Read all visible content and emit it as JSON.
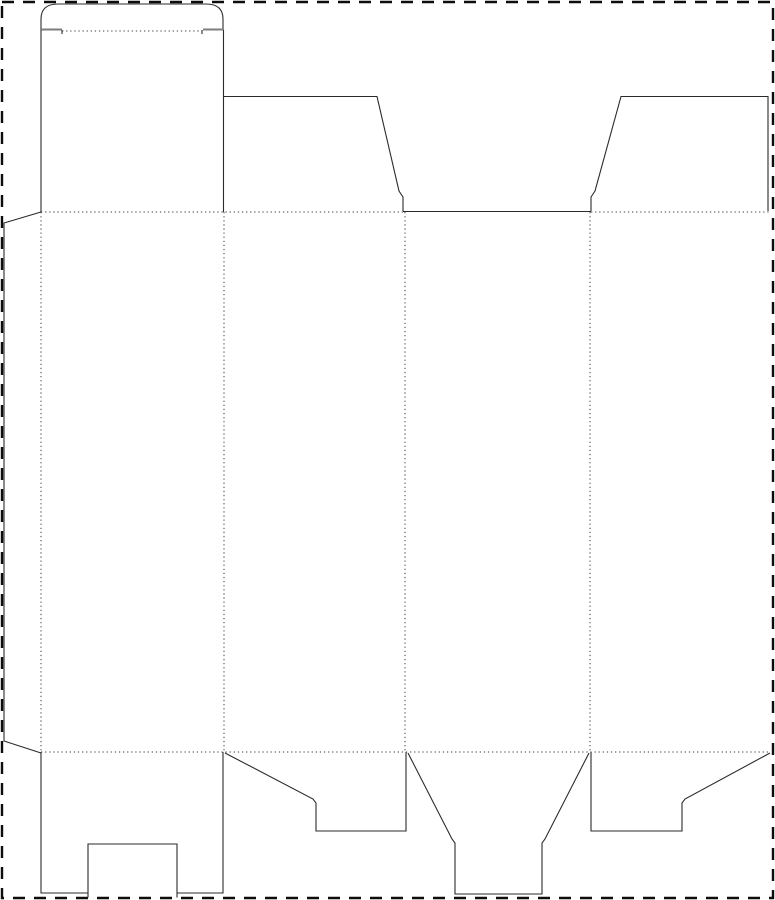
{
  "canvas": {
    "width": 775,
    "height": 900,
    "background": "#ffffff"
  },
  "colors": {
    "cut": "#2b2b2b",
    "fold": "#3f3f3f",
    "border": "#0d0d0d",
    "shoulder": "#7d7d7d"
  },
  "sheet_border": {
    "name": "sheet-border-dashed",
    "x": 2,
    "y": 2,
    "width": 771,
    "height": 896,
    "thickness": 2.4,
    "dash": "12 9"
  },
  "fold_lines": [
    {
      "name": "tuck-crease-fold",
      "d": "M 62 31 H 202"
    },
    {
      "name": "top-fold-left-segment",
      "d": "M 41 212 H 403"
    },
    {
      "name": "top-fold-right-segment",
      "d": "M 591 212 H 770"
    },
    {
      "name": "bottom-fold",
      "d": "M 41 752 H 770"
    },
    {
      "name": "glue-flap-fold",
      "d": "M 41 212 V 752"
    },
    {
      "name": "panel-divider-fold-1",
      "d": "M 224 212 V 752"
    },
    {
      "name": "panel-divider-fold-2",
      "d": "M 405 212 V 752"
    },
    {
      "name": "panel-divider-fold-3",
      "d": "M 590 212 V 752"
    }
  ],
  "cut_lines": [
    {
      "name": "tuck-flap-crown",
      "d": "M 41 30 V 19 Q 41 4 58 4 H 206 Q 223 4 223 19 V 30"
    },
    {
      "name": "tuck-shoulder-left",
      "d": "M 41 29.5 H 62",
      "width": 2,
      "color": "shoulder"
    },
    {
      "name": "tuck-shoulder-right",
      "d": "M 203 29.5 H 223",
      "width": 2,
      "color": "shoulder"
    },
    {
      "name": "tuck-crease-hook-left",
      "d": "M 62 30 V 34"
    },
    {
      "name": "tuck-crease-hook-right",
      "d": "M 202 30 V 34"
    },
    {
      "name": "tuck-neck-left-edge",
      "d": "M 41 30 V 212"
    },
    {
      "name": "tuck-neck-right-edge",
      "d": "M 223.5 30 V 212"
    },
    {
      "name": "top-dust-flap-left",
      "d": "M 224 96.5 H 377 L 399 191 L 403 197 V 211"
    },
    {
      "name": "top-opening-cut",
      "d": "M 403 211.5 H 591"
    },
    {
      "name": "top-dust-flap-right",
      "d": "M 591 211 V 197 L 595 191 L 621 96.5 H 768 V 211"
    },
    {
      "name": "glue-flap-outline",
      "d": "M 41 212 L 4 223 V 741 L 41 753"
    },
    {
      "name": "bottom-flap1-left-side",
      "d": "M 41 752 V 893 H 88"
    },
    {
      "name": "bottom-flap1-right-side",
      "d": "M 177 893 H 223 V 752"
    },
    {
      "name": "bottom-flap1-lock-notch",
      "d": "M 88 897.5 V 844 H 177 V 897.5"
    },
    {
      "name": "bottom-flap2-outline",
      "d": "M 225 753 L 313 799 L 316 803 V 831 H 406 V 752"
    },
    {
      "name": "bottom-flap3-funnel",
      "d": "M 408 753 L 452 839 L 455 843 V 894 H 542 V 843 L 545 839 L 589 753"
    },
    {
      "name": "bottom-flap4-outline",
      "d": "M 591 752 V 831 H 682 V 803 L 685 799 L 770 753"
    }
  ],
  "line_styles": {
    "cut_width": 1.1,
    "fold_width": 1,
    "fold_dash": "1.3 2.8"
  }
}
